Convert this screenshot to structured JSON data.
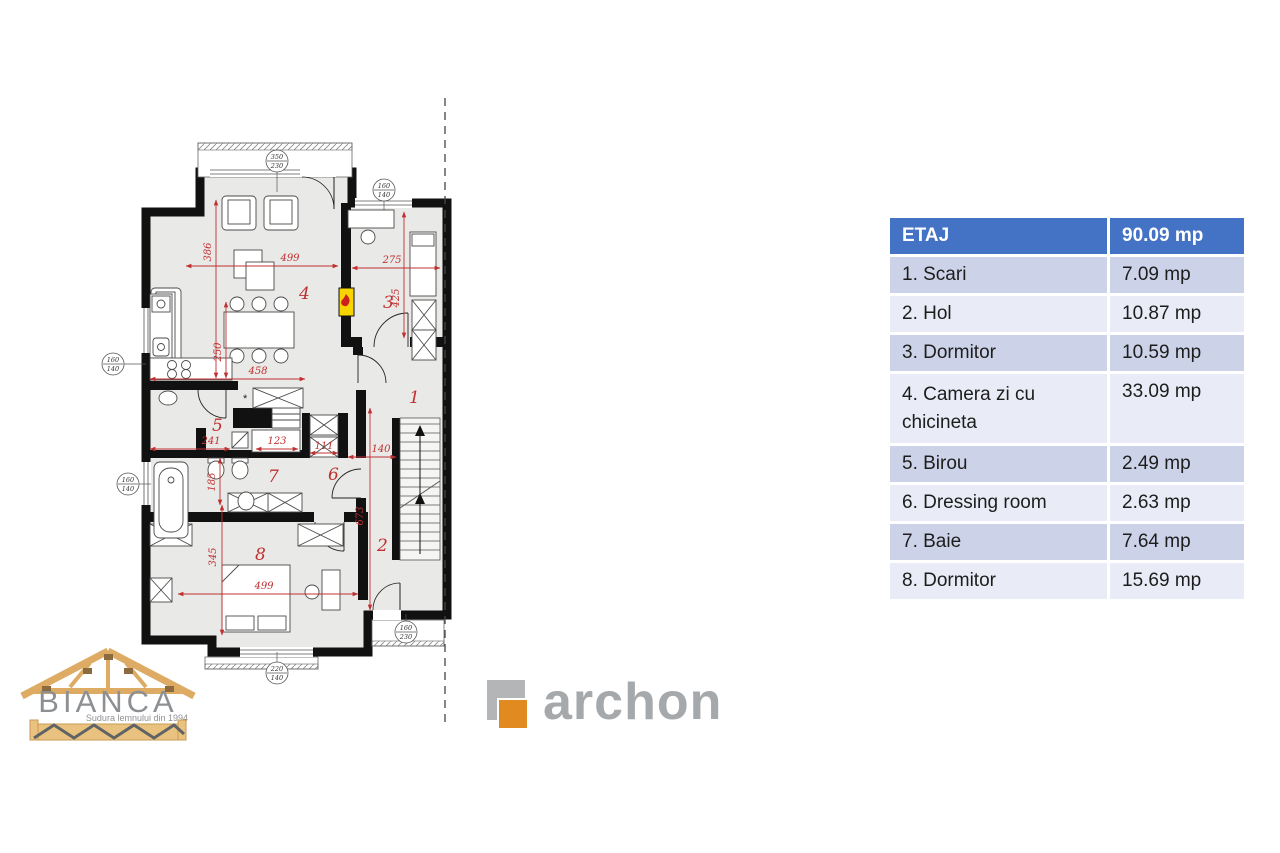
{
  "legend_table": {
    "header": {
      "label": "ETAJ",
      "value": "90.09 mp"
    },
    "rows": [
      {
        "label": "1. Scari",
        "value": "7.09 mp"
      },
      {
        "label": "2. Hol",
        "value": "10.87 mp"
      },
      {
        "label": "3. Dormitor",
        "value": "10.59 mp"
      },
      {
        "label": "4. Camera zi cu chicineta",
        "value": "33.09 mp"
      },
      {
        "label": "5. Birou",
        "value": "2.49 mp"
      },
      {
        "label": "6. Dressing room",
        "value": "2.63 mp"
      },
      {
        "label": "7. Baie",
        "value": "7.64 mp"
      },
      {
        "label": "8. Dormitor",
        "value": "15.69 mp"
      }
    ],
    "colors": {
      "header_bg": "#4472c4",
      "row_dark": "#ccd3e8",
      "row_light": "#e9ecf6"
    }
  },
  "floorplan": {
    "room_labels": [
      "1",
      "2",
      "3",
      "4",
      "5",
      "6",
      "7",
      "8"
    ],
    "dims": {
      "living_height": "386",
      "living_width": "499",
      "room3_width": "275",
      "room3_height": "425",
      "dining_width": "250",
      "kitchen_width": "458",
      "hall5_width": "241",
      "closet_width": "123",
      "dressing_width": "111",
      "hall_width": "140",
      "bath_height": "185",
      "room8_height": "345",
      "room8_width": "499",
      "stair_hall_height": "673"
    },
    "window_tags": [
      {
        "top": "350",
        "bottom": "230"
      },
      {
        "top": "160",
        "bottom": "140"
      },
      {
        "top": "160",
        "bottom": "140"
      },
      {
        "top": "160",
        "bottom": "140"
      },
      {
        "top": "220",
        "bottom": "140"
      },
      {
        "top": "160",
        "bottom": "230"
      }
    ],
    "colors": {
      "wall": "#111111",
      "floor": "#e9e9e7",
      "dimension_red": "#c03030",
      "fireplace_yellow": "#f7d400"
    }
  },
  "logos": {
    "bianca": {
      "name": "BIANCA",
      "tagline": "Sudura lemnului din 1994"
    },
    "archon": {
      "name": "archon",
      "accent_orange": "#e08a20",
      "gray": "#b3b5b7"
    }
  }
}
